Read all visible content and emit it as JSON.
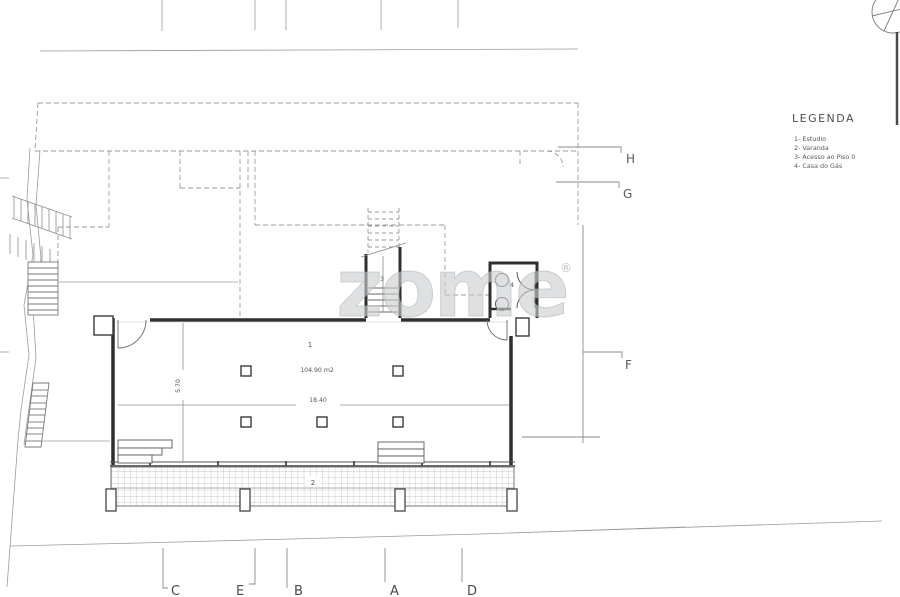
{
  "legend": {
    "title": "LEGENDA",
    "items": [
      "1- Estudio",
      "2- Varanda",
      "3- Acesso ao Piso 0",
      "4- Casa do Gás"
    ]
  },
  "grid_letters": {
    "right": [
      "H",
      "G",
      "F"
    ],
    "bottom": [
      "C",
      "E",
      "B",
      "A",
      "D"
    ]
  },
  "rooms": {
    "estudio": {
      "number": "1",
      "area": "104.90 m2"
    },
    "varanda": {
      "number": "2"
    },
    "stairs": {
      "number": "3"
    },
    "gas": {
      "number": "4"
    }
  },
  "dimensions": {
    "width": "18.40",
    "depth": "5.70"
  },
  "watermark": {
    "text": "zome",
    "reg": "®"
  },
  "colors": {
    "paper": "#ffffff",
    "wall": "#2f2f2f",
    "thin_line": "#8a8a8a",
    "dashed_line": "#9a9a9a",
    "hatch": "#b7b7b7",
    "text": "#4f4f4f",
    "watermark": "#c9cdcf"
  }
}
